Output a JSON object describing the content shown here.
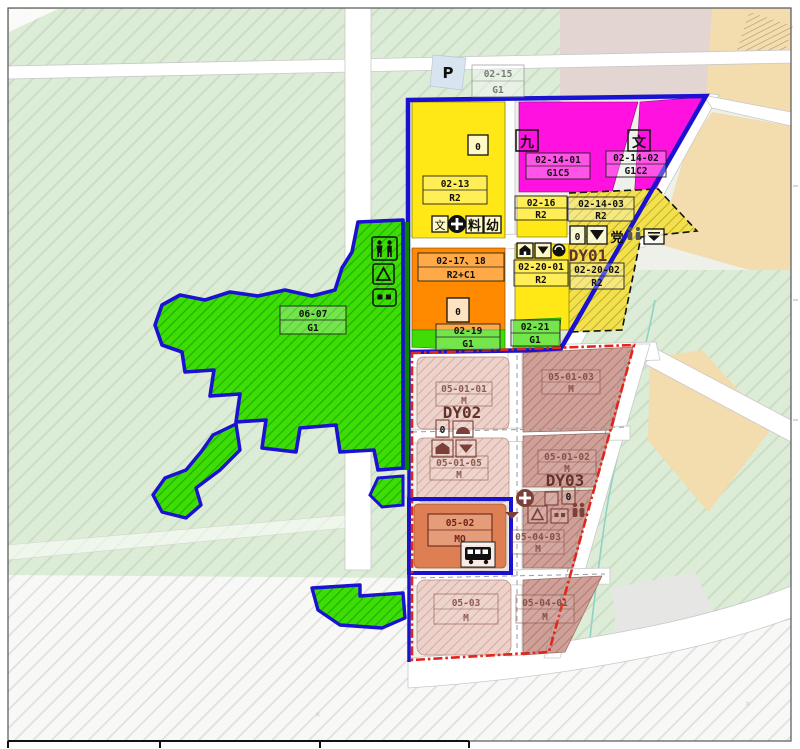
{
  "colors": {
    "boundary_blue": "#1a12d0",
    "boundary_red": "#e0261c",
    "residential_yellow": "#ffe815",
    "public_magenta": "#ff12e0",
    "mixed_orange": "#ff8a00",
    "green_space_bright": "#35d506",
    "pale_green_background": "#dcecd6",
    "industrial_pink_light": "#ecd2ca",
    "industrial_pink_dark": "#cfa098",
    "industrial_orange": "#dd7f52",
    "farmland_tan": "#f3dcae",
    "dusty_pink": "#e3d6d2"
  },
  "parcels": {
    "p02_15": {
      "code": "02-15",
      "use": "G1"
    },
    "p02_13": {
      "code": "02-13",
      "use": "R2"
    },
    "p02_14_01": {
      "code": "02-14-01",
      "use": "G1C5"
    },
    "p02_14_02": {
      "code": "02-14-02",
      "use": "G1C2"
    },
    "p02_16": {
      "code": "02-16",
      "use": "R2"
    },
    "p02_14_03": {
      "code": "02-14-03",
      "use": "R2"
    },
    "p02_17_18": {
      "code": "02-17、18",
      "use": "R2+C1"
    },
    "p02_19": {
      "code": "02-19",
      "use": "G1"
    },
    "p02_20_01": {
      "code": "02-20-01",
      "use": "R2"
    },
    "p02_20_02": {
      "code": "02-20-02",
      "use": "R2"
    },
    "p02_21": {
      "code": "02-21",
      "use": "G1"
    },
    "p06_07": {
      "code": "06-07",
      "use": "G1"
    },
    "p05_01_01": {
      "code": "05-01-01",
      "use": "M"
    },
    "p05_01_03": {
      "code": "05-01-03",
      "use": "M"
    },
    "p05_01_05": {
      "code": "05-01-05",
      "use": "M"
    },
    "p05_01_02": {
      "code": "05-01-02",
      "use": "M"
    },
    "p05_02": {
      "code": "05-02",
      "use": "MO"
    },
    "p05_04_03": {
      "code": "05-04-03",
      "use": "M"
    },
    "p05_03": {
      "code": "05-03",
      "use": "M"
    },
    "p05_04_01": {
      "code": "05-04-01",
      "use": "M"
    }
  },
  "districts": {
    "dy01": "DY01",
    "dy02": "DY02",
    "dy03": "DY03"
  },
  "glyphs": {
    "parking": "P",
    "zero": "0",
    "nine": "九",
    "wen": "文",
    "school": "文",
    "material": "料",
    "kindergarten": "幼",
    "party": "党"
  }
}
